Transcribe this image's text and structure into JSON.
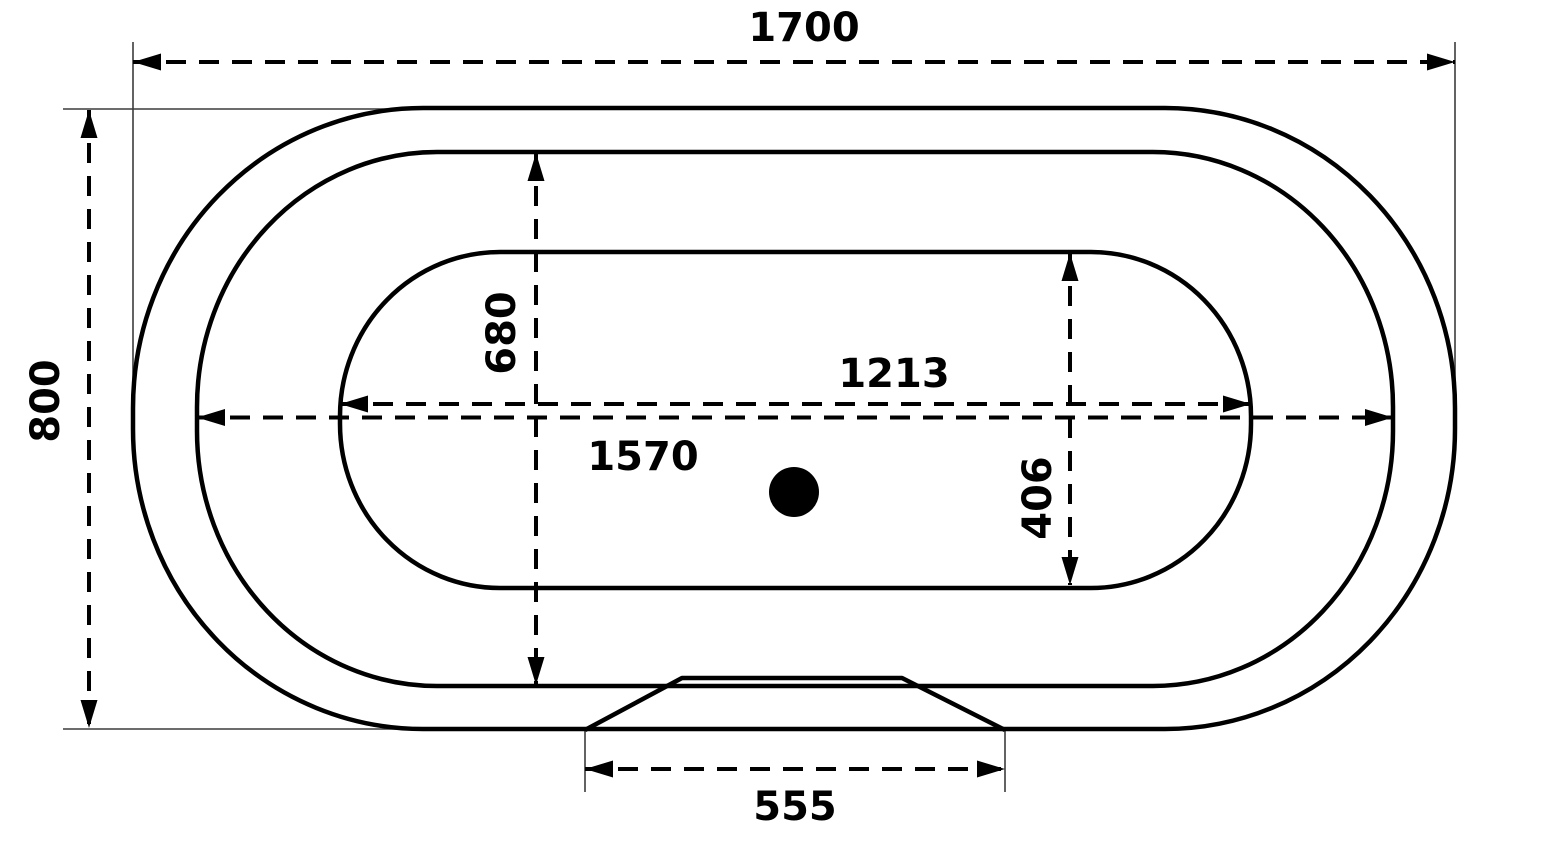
{
  "title": "Bathtub plan view technical drawing with dimensions",
  "colors": {
    "line": "#000000",
    "extension_line": "#3c3c3c",
    "background": "#ffffff"
  },
  "drawing": {
    "canvas": {
      "width": 1546,
      "height": 848
    },
    "contours": [
      {
        "id": "tub-outer-rim",
        "x": 133,
        "y": 108,
        "w": 1322,
        "h": 621,
        "rx": 290,
        "ry": 300,
        "stroke_w": 4.5
      },
      {
        "id": "tub-inner-rim",
        "x": 197,
        "y": 152,
        "w": 1196,
        "h": 534,
        "rx": 240,
        "ry": 255,
        "stroke_w": 4.5
      },
      {
        "id": "tub-basin",
        "x": 340,
        "y": 252,
        "w": 911,
        "h": 336,
        "rx": 160,
        "ry": 164,
        "stroke_w": 4.5
      }
    ],
    "apron": {
      "id": "bottom-apron-recess",
      "points": "585,730 682,678 902,678 1005,730",
      "stroke_w": 4.5
    },
    "drain": {
      "cx": 794,
      "cy": 492,
      "r": 25
    },
    "extension_lines": [
      {
        "x1": 133,
        "y1": 42,
        "x2": 133,
        "y2": 418
      },
      {
        "x1": 1455,
        "y1": 42,
        "x2": 1455,
        "y2": 418
      },
      {
        "x1": 63,
        "y1": 109,
        "x2": 430,
        "y2": 109
      },
      {
        "x1": 63,
        "y1": 729,
        "x2": 450,
        "y2": 729
      },
      {
        "x1": 585,
        "y1": 729,
        "x2": 585,
        "y2": 792
      },
      {
        "x1": 1005,
        "y1": 729,
        "x2": 1005,
        "y2": 792
      }
    ],
    "dimensions": [
      {
        "id": "overall-length",
        "label": "1700",
        "orient": "h",
        "y": 62,
        "x1": 133,
        "x2": 1455,
        "label_x": 804,
        "label_y": 28,
        "rotated": false
      },
      {
        "id": "overall-width",
        "label": "800",
        "orient": "v",
        "x": 89,
        "y1": 110,
        "y2": 728,
        "label_x": 46,
        "label_y": 401,
        "rotated": true
      },
      {
        "id": "rim-inner-width",
        "label": "680",
        "orient": "v",
        "x": 536,
        "y1": 153,
        "y2": 685,
        "label_x": 502,
        "label_y": 333,
        "rotated": true
      },
      {
        "id": "basin-length",
        "label": "1213",
        "orient": "h",
        "y": 404,
        "x1": 340,
        "x2": 1251,
        "label_x": 894,
        "label_y": 374,
        "rotated": false
      },
      {
        "id": "rim-inner-length",
        "label": "1570",
        "orient": "h",
        "y": 417.5,
        "x1": 197,
        "x2": 1393,
        "label_x": 643,
        "label_y": 457,
        "rotated": false
      },
      {
        "id": "basin-width",
        "label": "406",
        "orient": "v",
        "x": 1070,
        "y1": 253,
        "y2": 585,
        "label_x": 1038,
        "label_y": 498,
        "rotated": true
      },
      {
        "id": "apron-recess-width",
        "label": "555",
        "orient": "h",
        "y": 769,
        "x1": 585,
        "x2": 1005,
        "label_x": 795,
        "label_y": 807,
        "rotated": false
      }
    ],
    "style": {
      "dim_stroke_w": 4,
      "dim_dash": "20 13",
      "ext_stroke_w": 1.6,
      "arrow_len": 28,
      "arrow_half_w": 8.5
    }
  }
}
